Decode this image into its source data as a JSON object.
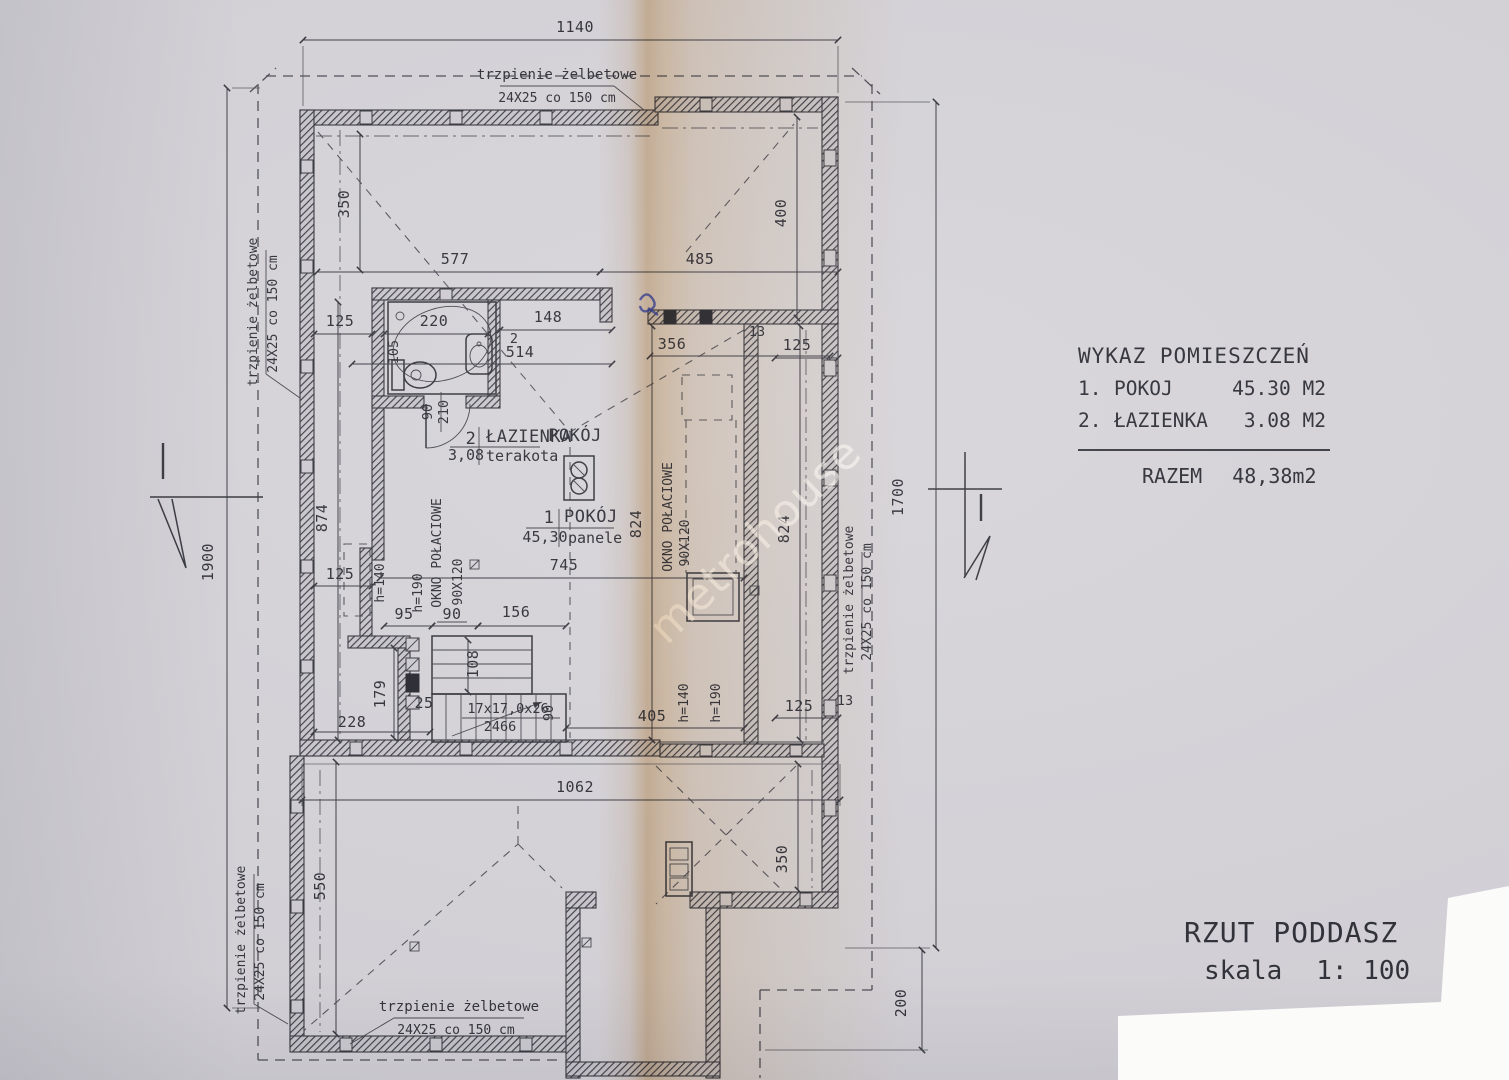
{
  "title_block": {
    "title": "RZUT PODDASZ",
    "scale_label": "skala",
    "scale_value": "1: 100"
  },
  "schedule": {
    "title": "WYKAZ POMIESZCZEŃ",
    "rows": [
      {
        "no": "1.",
        "name": "POKOJ",
        "area": "45.30 M2"
      },
      {
        "no": "2.",
        "name": "ŁAZIENKA",
        "area": "3.08 M2"
      }
    ],
    "total_label": "RAZEM",
    "total_value": "48,38m2"
  },
  "watermark": {
    "text": "metrohouse"
  },
  "note": {
    "line1": "trzpienie żelbetowe",
    "line2": "24X25 co 150 cm"
  },
  "rooms": {
    "bathroom": {
      "no": "2",
      "name": "ŁAZIENKA",
      "area": "3,08",
      "floor": "terakota"
    },
    "room1": {
      "no": "1",
      "name": "POKÓJ",
      "area": "45,30",
      "floor": "panele"
    },
    "room1_header": "POKÓJ"
  },
  "windows": {
    "left": {
      "label": "OKNO POŁACIOWE",
      "size": "90X120",
      "h_sill": "h=140",
      "h_top": "h=190"
    },
    "right": {
      "label": "OKNO POŁACIOWE",
      "size": "90X120"
    },
    "bottom": {
      "h_sill": "h=140",
      "h_top": "h=190"
    }
  },
  "stairs": {
    "spec": "17x17,0x26",
    "run": "2466"
  },
  "dims": {
    "b1140": "1140",
    "b1900": "1900",
    "b1700": "1700",
    "b200": "200",
    "t350": "350",
    "t577": "577",
    "t485": "485",
    "t400": "400",
    "bath125": "125",
    "bath220": "220",
    "bath148": "148",
    "bath2": "2",
    "bath105": "105",
    "bath514": "514",
    "m356": "356",
    "m13": "13",
    "tr125": "125",
    "door90": "90",
    "door210": "210",
    "l874": "874",
    "m824a": "824",
    "m824b": "824",
    "l125": "125",
    "m745": "745",
    "s95": "95",
    "s90": "90",
    "s156": "156",
    "s108": "108",
    "s25": "25",
    "s90w": "90",
    "b405": "405",
    "br125": "125",
    "br13": "13",
    "b228": "228",
    "b179": "179",
    "b1062": "1062",
    "b550": "550",
    "br350": "350"
  },
  "colors": {
    "paper": "#d6d4d9",
    "ink": "#33333b",
    "fold": "#dfb480",
    "pen_mark": "#2f3fc0"
  }
}
